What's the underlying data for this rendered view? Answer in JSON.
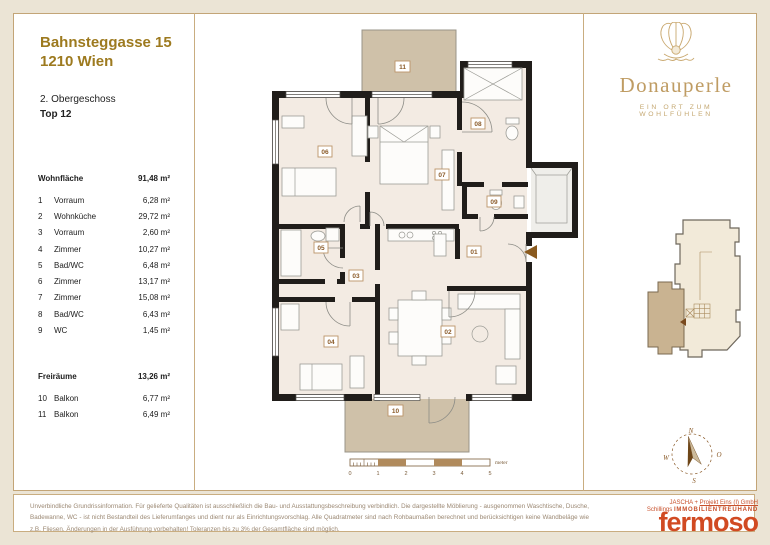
{
  "header": {
    "address_line1": "Bahnsteggasse 15",
    "address_line2": "1210 Wien",
    "floor": "2. Obergeschoss",
    "unit": "Top 12"
  },
  "wohnflaeche": {
    "label": "Wohnfläche",
    "total": "91,48 m²",
    "rooms": [
      {
        "num": "1",
        "name": "Vorraum",
        "area": "6,28 m²"
      },
      {
        "num": "2",
        "name": "Wohnküche",
        "area": "29,72 m²"
      },
      {
        "num": "3",
        "name": "Vorraum",
        "area": "2,60 m²"
      },
      {
        "num": "4",
        "name": "Zimmer",
        "area": "10,27 m²"
      },
      {
        "num": "5",
        "name": "Bad/WC",
        "area": "6,48 m²"
      },
      {
        "num": "6",
        "name": "Zimmer",
        "area": "13,17 m²"
      },
      {
        "num": "7",
        "name": "Zimmer",
        "area": "15,08 m²"
      },
      {
        "num": "8",
        "name": "Bad/WC",
        "area": "6,43 m²"
      },
      {
        "num": "9",
        "name": "WC",
        "area": "1,45 m²"
      }
    ]
  },
  "freiraeume": {
    "label": "Freiräume",
    "total": "13,26 m²",
    "rooms": [
      {
        "num": "10",
        "name": "Balkon",
        "area": "6,77 m²"
      },
      {
        "num": "11",
        "name": "Balkon",
        "area": "6,49 m²"
      }
    ]
  },
  "brand": {
    "name": "Donauperle",
    "tagline": "EIN ORT ZUM WOHLFÜHLEN"
  },
  "plan": {
    "room_labels": [
      "01",
      "02",
      "03",
      "04",
      "05",
      "06",
      "07",
      "08",
      "09",
      "10",
      "11"
    ],
    "scale": {
      "ticks": [
        "0",
        "1",
        "2",
        "3",
        "4",
        "5"
      ],
      "unit": "meter"
    }
  },
  "compass": {
    "n": "N",
    "o": "O",
    "s": "S",
    "w": "W"
  },
  "footer": {
    "disclaimer": "Unverbindliche Grundrissinformation. Für gelieferte Qualitäten ist ausschließlich die Bau- und Ausstattungsbeschreibung verbindlich. Die dargestellte Möblierung - ausgenommen Waschtische, Dusche, Badewanne, WC - ist nicht Bestandteil des Lieferumfanges und dient nur als Einrichtungsvorschlag. Alle Quadratmeter sind nach Rohbaumaßen berechnet und berücksichtigen keine Wandbeläge wie z.B. Fliesen. Änderungen in der Ausführung vorbehalten! Toleranzen bis zu 3% der Gesamtfläche sind möglich.",
    "company_prefix": "JASCHA +",
    "company_link": "Projekt Eins (I) GmbH",
    "company_left": "Schillings",
    "company_right": "IMMOBILIENTREUHAND",
    "logo": "fermoso"
  },
  "colors": {
    "accent_gold": "#9d7a1f",
    "brand_gold": "#bf9c63",
    "fermoso_red": "#d14a22",
    "balcony_tan": "#cfc1a9",
    "wall_black": "#201d1a",
    "page_cream": "#ebe4d5"
  }
}
